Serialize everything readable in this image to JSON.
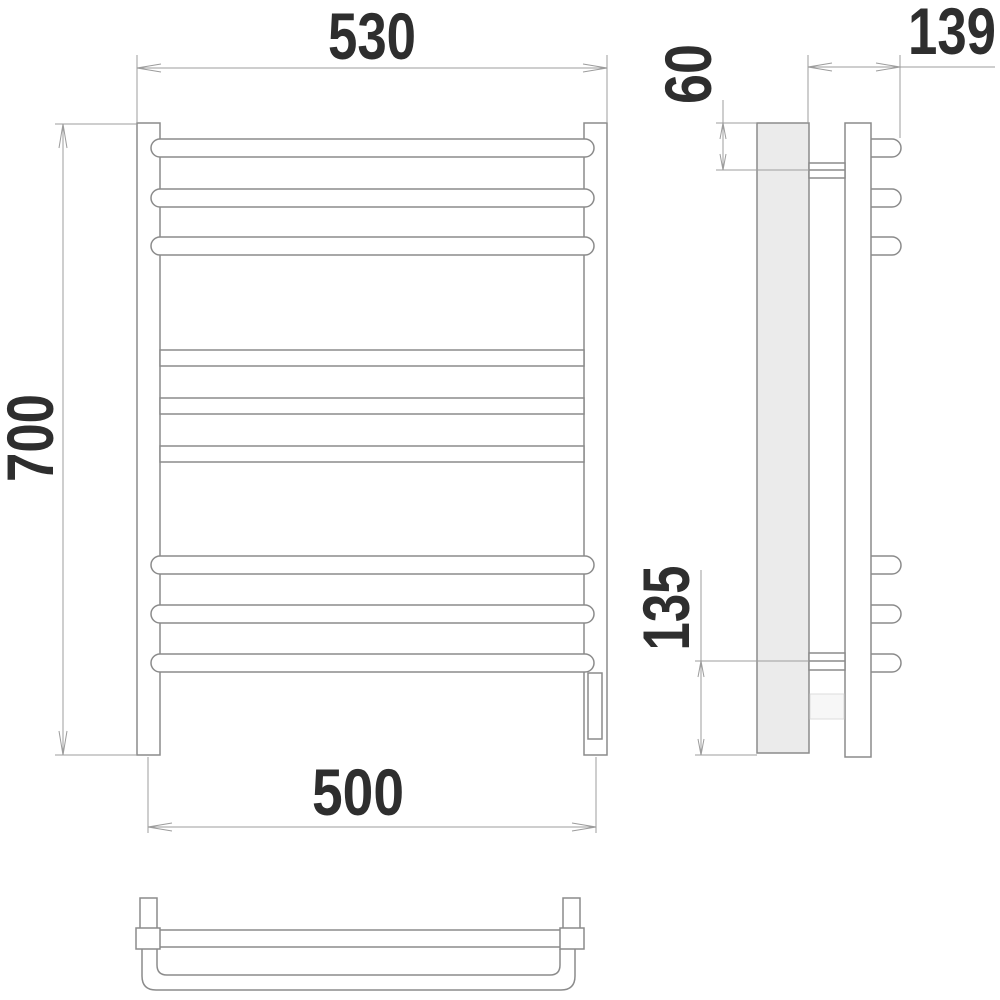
{
  "drawing": {
    "type": "technical-dimension-drawing",
    "subject": "ladder towel rail (front, side and bottom views)",
    "dimensions": {
      "overall_width": "530",
      "overall_height": "700",
      "connection_spacing": "500",
      "depth": "139",
      "top_bracket_offset": "60",
      "bottom_bracket_offset": "135"
    },
    "colors": {
      "line": "#8b8b8b",
      "dim_line": "#9c9c9c",
      "text": "#2e2e2e",
      "wall_fill": "#ebebeb",
      "background": "#ffffff"
    }
  }
}
